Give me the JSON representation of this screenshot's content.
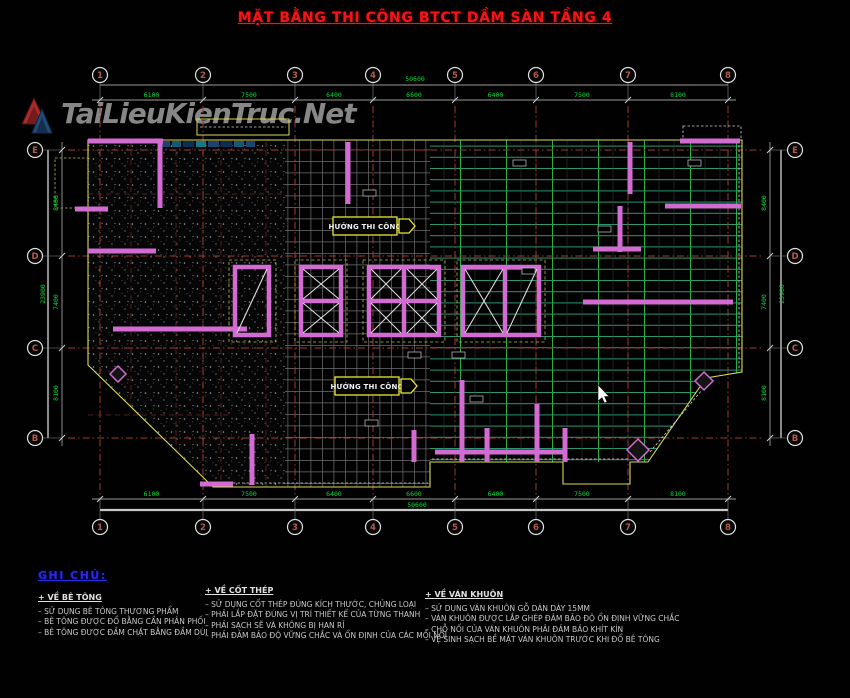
{
  "title": "MẶT BẰNG THI CÔNG BTCT DẦM SÀN TẦNG 4",
  "watermark": {
    "text": "TaiLieuKienTruc.Net"
  },
  "grid": {
    "columns": [
      "1",
      "2",
      "3",
      "4",
      "5",
      "6",
      "7",
      "8"
    ],
    "rows": [
      "E",
      "D",
      "C",
      "B"
    ]
  },
  "dimensions": {
    "top": [
      "6100",
      "7500",
      "6400",
      "6600",
      "6400",
      "7500",
      "8100"
    ],
    "top_total": "50600",
    "bottom": [
      "6100",
      "7500",
      "6400",
      "6600",
      "6400",
      "7500",
      "8100"
    ],
    "bottom_total": "50600",
    "left": [
      "8400",
      "7400",
      "8100"
    ],
    "left_total": "23900",
    "right": [
      "8400",
      "7400",
      "8100"
    ],
    "right_total": "23900"
  },
  "labels": {
    "direction1": "HƯỚNG THI CÔNG",
    "direction2": "HƯỚNG THI CÔNG"
  },
  "notes": {
    "header": "GHI CHÚ:",
    "sections": [
      {
        "title": "+ VỀ BÊ TÔNG",
        "items": [
          "–  SỬ DỤNG BÊ TÔNG THƯƠNG PHẨM",
          "–  BÊ TÔNG ĐƯỢC ĐỔ BẰNG CẦN PHÂN PHỐI",
          "–  BÊ TÔNG ĐƯỢC ĐẦM CHẶT BẰNG ĐẦM DÙI"
        ]
      },
      {
        "title": "+ VỀ CỐT THÉP",
        "items": [
          "–  SỬ DỤNG CỐT THÉP ĐÚNG KÍCH THƯỚC, CHỦNG LOẠI",
          "–  PHẢI LẮP ĐẶT ĐÚNG VỊ TRÍ THIẾT KẾ CỦA TỪNG THANH",
          "–  PHẢI SẠCH SẼ VÀ KHÔNG BỊ HAN RỈ",
          "–  PHẢI ĐẢM BẢO ĐỘ VỮNG CHẮC VÀ ỔN ĐỊNH CỦA CÁC MỐI NỐI"
        ]
      },
      {
        "title": "+ VỀ VÁN KHUÔN",
        "items": [
          "–  SỬ DỤNG VÁN KHUÔN GỖ DÁN DÀY 15MM",
          "–  VÁN KHUÔN ĐƯỢC LẮP GHÉP ĐẢM BẢO ĐỘ ỔN ĐỊNH VỮNG CHẮC",
          "–  CHỖ NỐI CỦA VÁN KHUÔN PHẢI ĐẢM BẢO KHÍT KÍN",
          "–  VỆ SINH SẠCH BỀ MẶT VÁN KHUÔN TRƯỚC KHI ĐỔ BÊ TÔNG"
        ]
      }
    ]
  },
  "colors": {
    "background": "#010101",
    "title_red": "#f21616",
    "dimension_green": "#00dc3c",
    "wall_magenta": "#d26bd2",
    "outline_yellow": "#d8d855",
    "beam_teal": "#2a9a72",
    "beam_green": "#25b048",
    "note_blue": "#2b2bdd"
  }
}
